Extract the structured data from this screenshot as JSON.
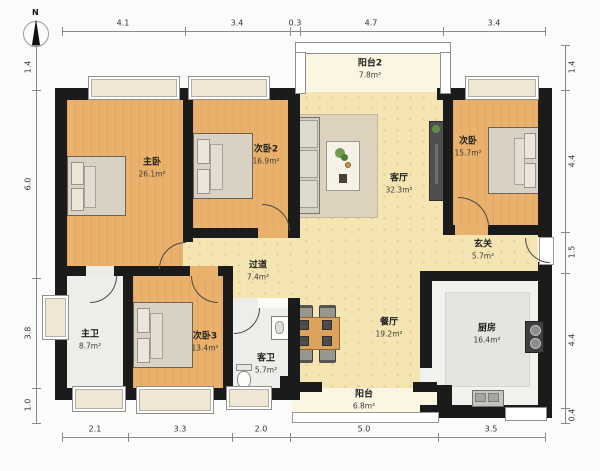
{
  "compass": {
    "label": "N"
  },
  "rooms": {
    "master_bedroom": {
      "name": "主卧",
      "area": "26.1m²"
    },
    "bedroom2": {
      "name": "次卧2",
      "area": "16.9m²"
    },
    "bedroom_right": {
      "name": "次卧",
      "area": "15.7m²"
    },
    "bedroom3": {
      "name": "次卧3",
      "area": "13.4m²"
    },
    "living_room": {
      "name": "客厅",
      "area": "32.3m²"
    },
    "dining_room": {
      "name": "餐厅",
      "area": "19.2m²"
    },
    "kitchen": {
      "name": "厨房",
      "area": "16.4m²"
    },
    "master_bath": {
      "name": "主卫",
      "area": "8.7m²"
    },
    "guest_bath": {
      "name": "客卫",
      "area": "5.7m²"
    },
    "hallway": {
      "name": "过道",
      "area": "7.4m²"
    },
    "entry": {
      "name": "玄关",
      "area": "5.7m²"
    },
    "balcony2": {
      "name": "阳台2",
      "area": "7.8m²"
    },
    "balcony": {
      "name": "阳台",
      "area": "6.8m²"
    }
  },
  "dimensions": {
    "top": [
      "4.1",
      "3.4",
      "0.3",
      "4.7",
      "3.4"
    ],
    "bottom": [
      "2.1",
      "3.3",
      "2.0",
      "5.0",
      "3.5"
    ],
    "left": [
      "1.4",
      "6.0",
      "3.8",
      "1.0"
    ],
    "right": [
      "1.4",
      "4.4",
      "1.5",
      "4.4",
      "0.4"
    ]
  },
  "colors": {
    "wall": "#1b1b1b",
    "wood_floor": "#e9b16b",
    "living_floor": "#f4e5b2",
    "tile_floor": "#ededea",
    "balcony_floor": "#faf6e2",
    "dimension_text": "#333333"
  }
}
